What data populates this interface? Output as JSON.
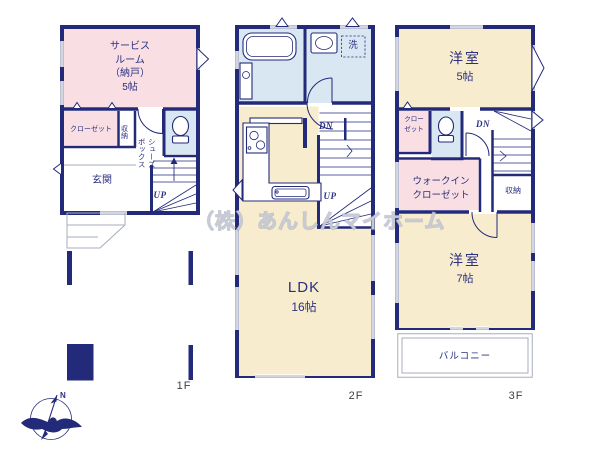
{
  "watermark": "（株）あんしんマイホーム",
  "compass": {
    "north": "N"
  },
  "colors": {
    "wall": "#232a7a",
    "ink": "#2b3180",
    "pink": "#f9dee3",
    "cream": "#f8ecce",
    "blue": "#d9e7f2",
    "grayline": "#a8adbd",
    "floor_label": "#3a3f4a"
  },
  "floors": {
    "f1": {
      "label": "1F",
      "rooms": {
        "service": "サービス\nルーム\n（納戸）\n5帖",
        "closet": "クローゼット",
        "storage": "収納",
        "shoebox": "シューズ\nボックス",
        "entrance": "玄関",
        "up": "UP"
      }
    },
    "f2": {
      "label": "2F",
      "rooms": {
        "laundry": "洗",
        "dn": "DN",
        "up": "UP",
        "ldk": "LDK",
        "ldk_size": "16帖"
      }
    },
    "f3": {
      "label": "3F",
      "rooms": {
        "bedroom5": "洋室",
        "bedroom5_size": "5帖",
        "closet": "クロー\nゼット",
        "dn": "DN",
        "wic": "ウォークイン\nクローゼット",
        "storage": "収納",
        "bedroom7": "洋室",
        "bedroom7_size": "7帖",
        "balcony": "バルコニー"
      }
    }
  }
}
